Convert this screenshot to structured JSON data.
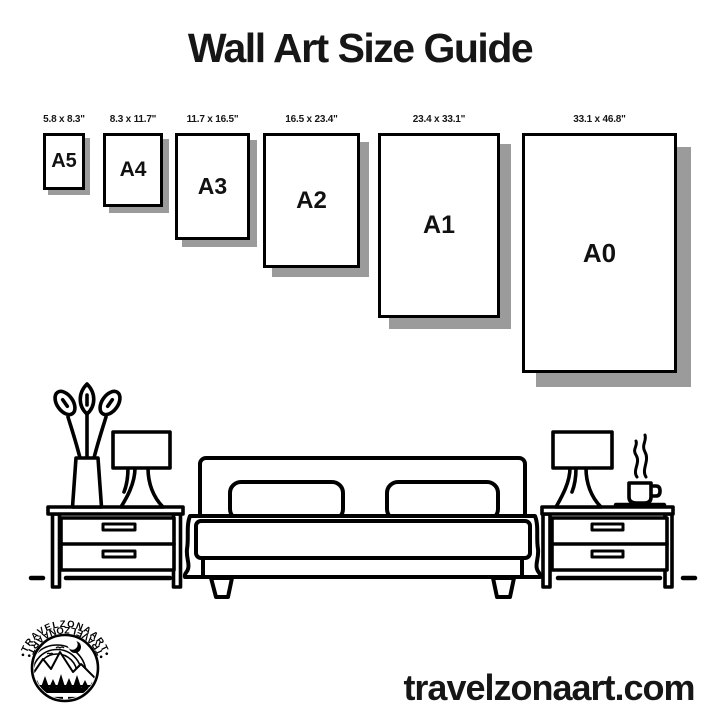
{
  "title": "Wall Art Size Guide",
  "sizes": [
    {
      "name": "A5",
      "dimensions": "5.8 x 8.3\""
    },
    {
      "name": "A4",
      "dimensions": "8.3 x 11.7\""
    },
    {
      "name": "A3",
      "dimensions": "11.7 x 16.5\""
    },
    {
      "name": "A2",
      "dimensions": "16.5 x 23.4\""
    },
    {
      "name": "A1",
      "dimensions": "23.4 x 33.1\""
    },
    {
      "name": "A0",
      "dimensions": "33.1 x 46.8\""
    }
  ],
  "website": "travelzonaart.com",
  "logo": {
    "arc_top": "•TRAVELZONAART•",
    "arc_bottom": "•TRAVELZONAART•"
  },
  "scene": {
    "objects": [
      "plant-vase",
      "table-lamp",
      "nightstand",
      "double-bed",
      "pillows",
      "coffee-cup"
    ]
  },
  "colors": {
    "ink": "#000000",
    "shadow": "#9b9b9b",
    "background": "#ffffff"
  }
}
